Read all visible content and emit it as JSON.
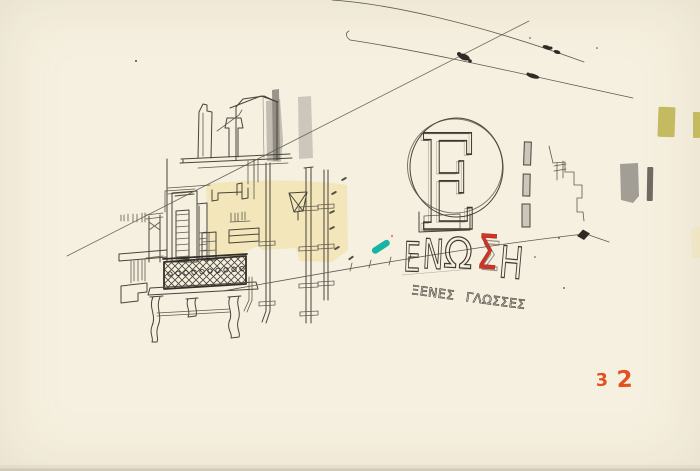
{
  "artwork": {
    "kind": "urban-sketch",
    "logo": {
      "letter": "E"
    },
    "sign": {
      "word": "ΕΝΩΣΗ",
      "letters": [
        "Ε",
        "Ν",
        "Ω",
        "Σ",
        "Η"
      ],
      "highlight_letter": "Σ",
      "subtitle": "ΞΕΝΕΣ ΓΛΩΣΣΕΣ"
    },
    "page_number": {
      "value": "32",
      "digits": [
        "3",
        "2"
      ]
    },
    "palette": {
      "paper": "#f6f0e0",
      "ink": "#49443b",
      "red_sigma": "#cd3527",
      "page_number_orange": "#e2521f",
      "teal_accent": "#17b3a4",
      "yellow_wash": "#f1e1a9",
      "olive_swatch": "#c4ba5f",
      "gray_wash": "#a29e96",
      "dark_gray_swatch": "#6e6a61"
    }
  }
}
